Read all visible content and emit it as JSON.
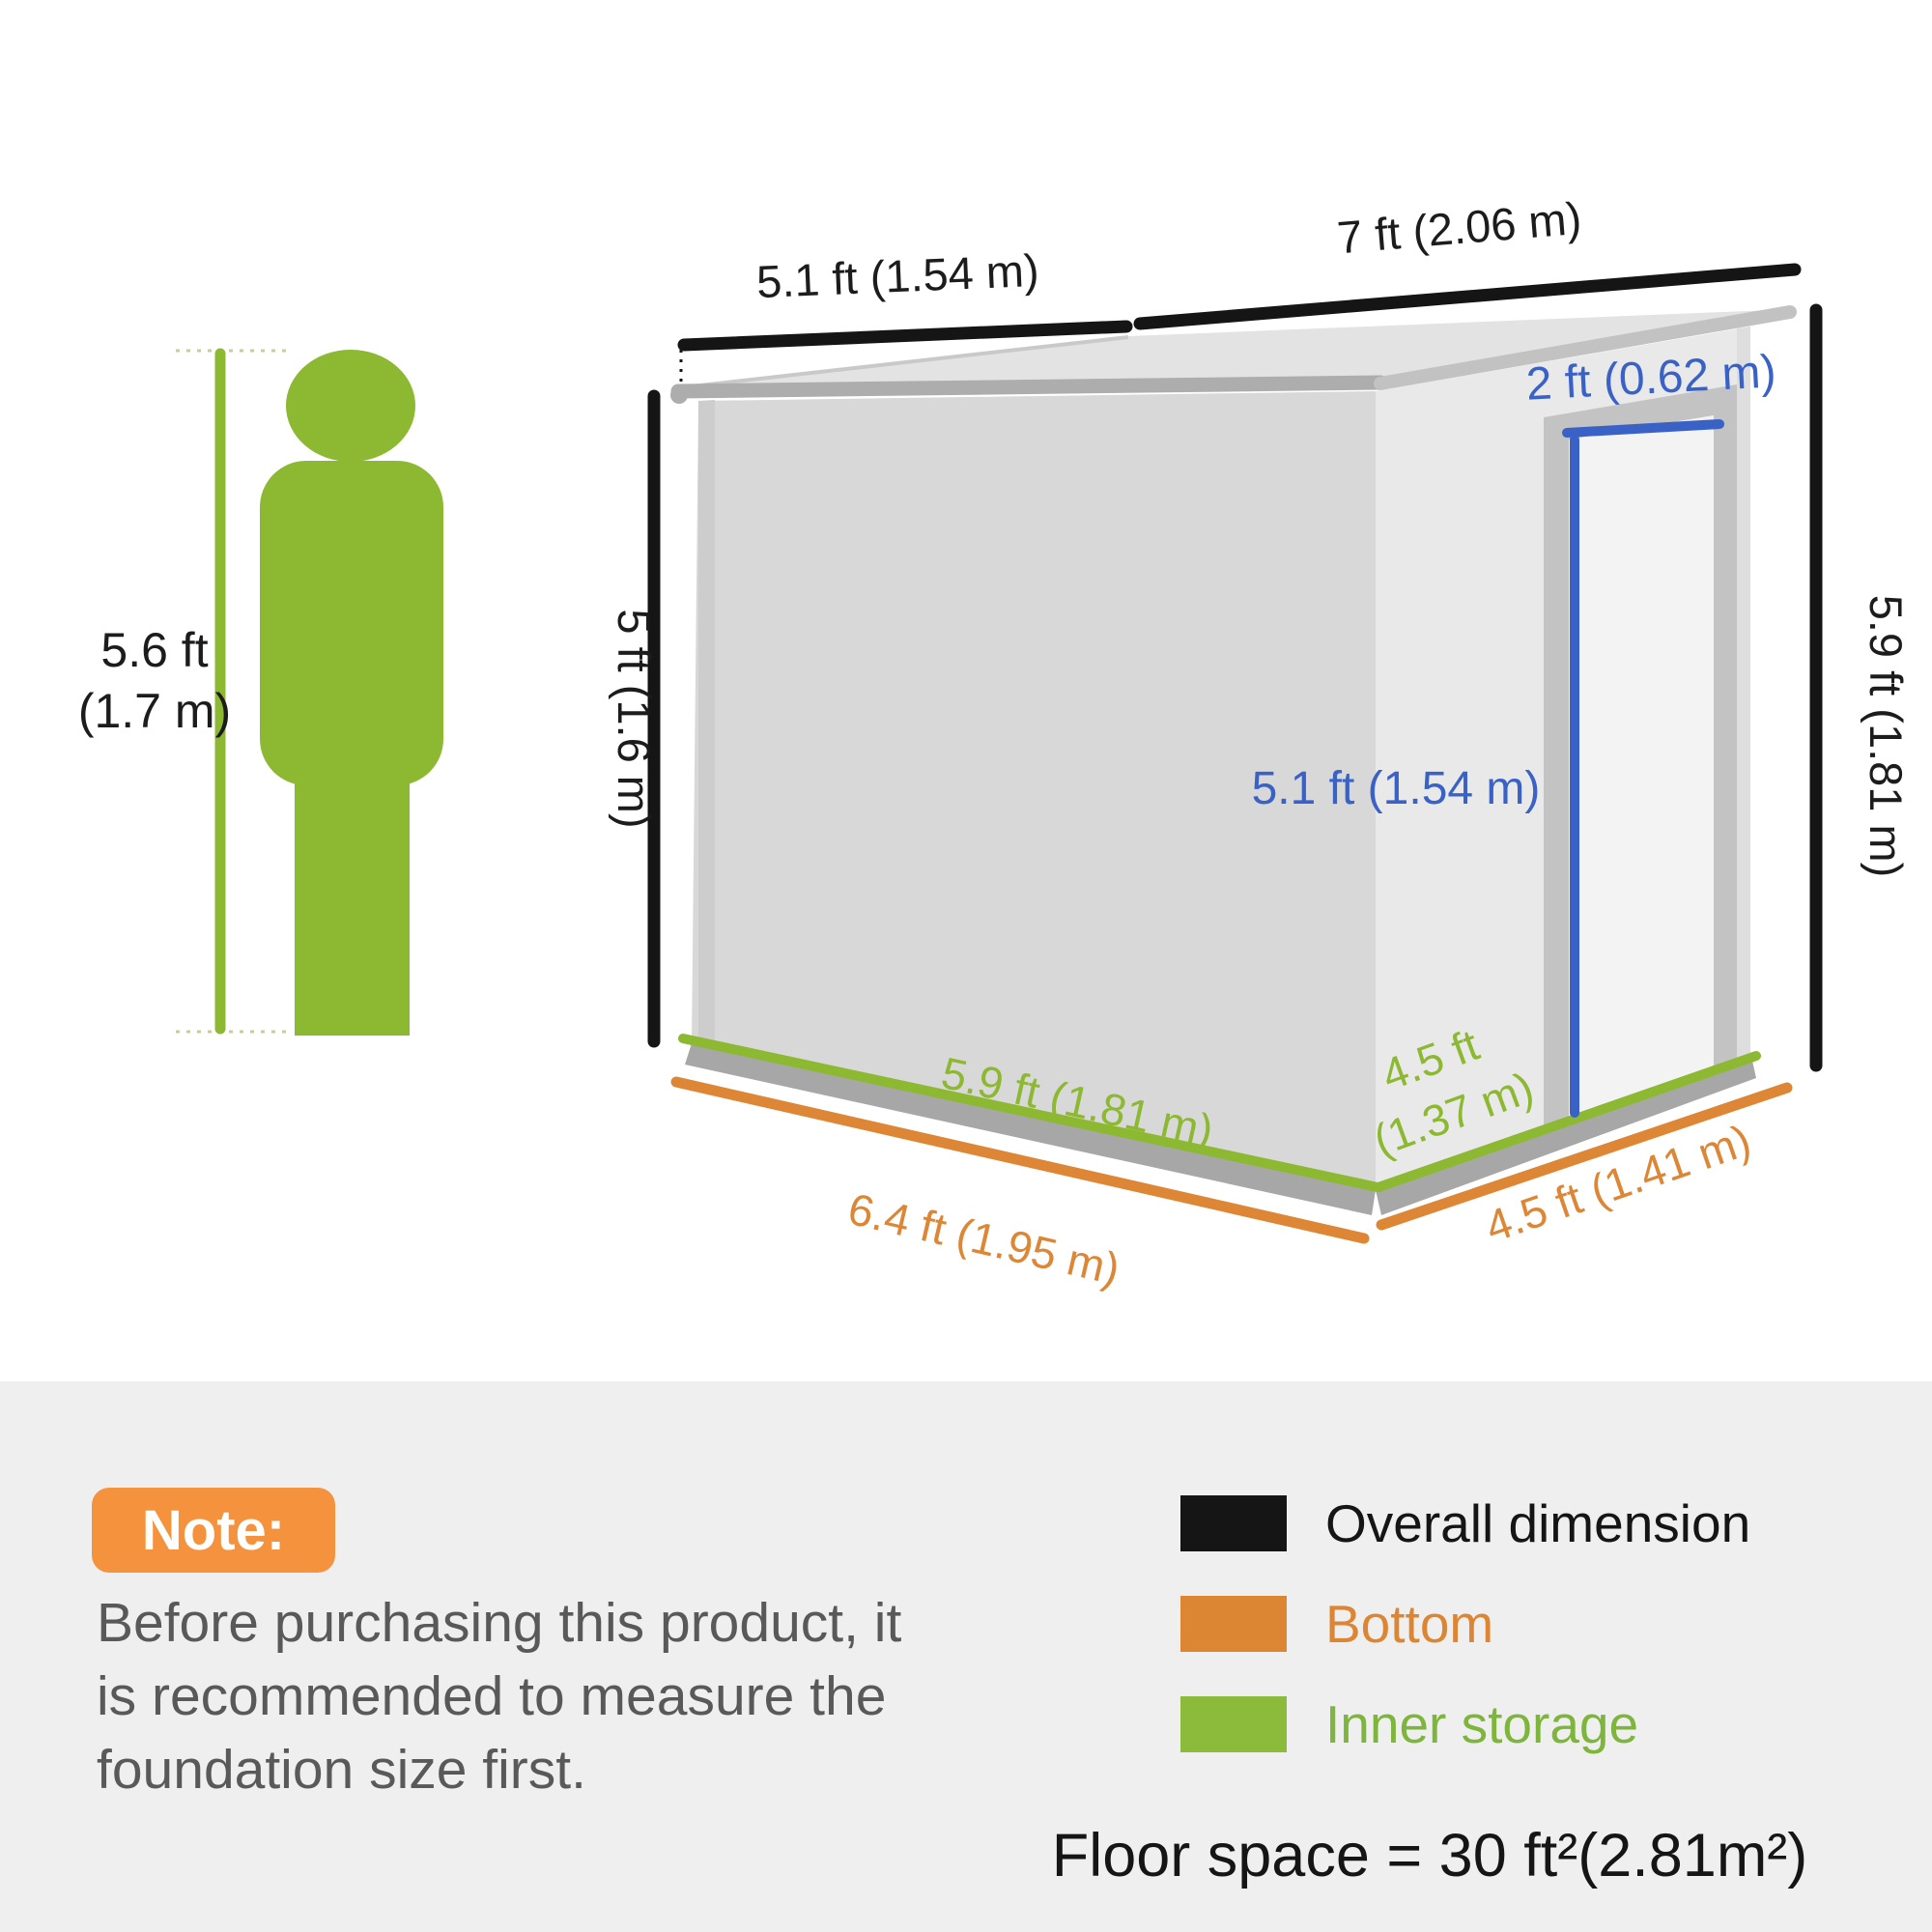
{
  "person": {
    "height_line1": "5.6 ft",
    "height_line2": "(1.7 m)"
  },
  "dimensions": {
    "roof_left": "5.1 ft (1.54 m)",
    "roof_right": "7 ft (2.06 m)",
    "height_left": "5 ft (1.6 m)",
    "height_right": "5.9 ft (1.81 m)",
    "door_width": "2 ft (0.62 m)",
    "door_height": "5.1 ft (1.54 m)",
    "inner_front": "5.9 ft (1.81 m)",
    "inner_side_line1": "4.5 ft",
    "inner_side_line2": "(1.37 m)",
    "bottom_front": "6.4 ft (1.95 m)",
    "bottom_side": "4.5 ft (1.41 m)"
  },
  "note": {
    "badge": "Note:",
    "lines": [
      "Before purchasing this product, it",
      "is recommended to measure the",
      "foundation size first."
    ]
  },
  "legend": {
    "items": [
      {
        "label": "Overall dimension",
        "color": "#151515"
      },
      {
        "label": "Bottom",
        "color": "#DC8634"
      },
      {
        "label": "Inner storage",
        "color": "#8CBB3B"
      }
    ]
  },
  "floor_space": "Floor space = 30 ft²(2.81m²)",
  "colors": {
    "green": "#8CB931",
    "orange": "#DD8636",
    "blue": "#3A62C6",
    "badge_orange": "#F5923E",
    "note_text": "#595959",
    "panel_background": "#EFEFEF",
    "dimension_black": "#151515"
  }
}
